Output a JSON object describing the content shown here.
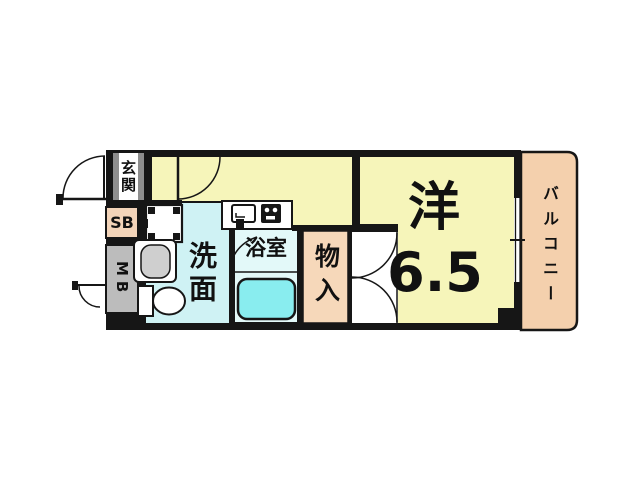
{
  "plan_title": "1K apartment floor plan",
  "rooms": {
    "entrance": {
      "label": "玄関"
    },
    "shoe_box": {
      "label": "SB"
    },
    "meter_box": {
      "label": "MB"
    },
    "washroom": {
      "label": "洗面"
    },
    "bathroom": {
      "label": "浴室"
    },
    "storage": {
      "label": "物入"
    },
    "western_room": {
      "label": "洋",
      "size": "6.5"
    },
    "balcony": {
      "label": "バルコニー"
    }
  },
  "fixtures": [
    "washing-machine-space",
    "washbasin",
    "toilet",
    "bathtub",
    "kitchen-sink",
    "gas-stove"
  ],
  "colors": {
    "room_yellow": "#f6f5ba",
    "washroom_cyan": "#cff2f4",
    "bathroom_cyan": "#e3f9f9",
    "bathtub_cyan": "#89edef",
    "storage_peach": "#f6d8ba",
    "balcony_peach": "#f4d0ad",
    "shoe_box_peach": "#f3d4b9",
    "meter_box_gray": "#bcbcbc",
    "wall_black": "#161616"
  }
}
